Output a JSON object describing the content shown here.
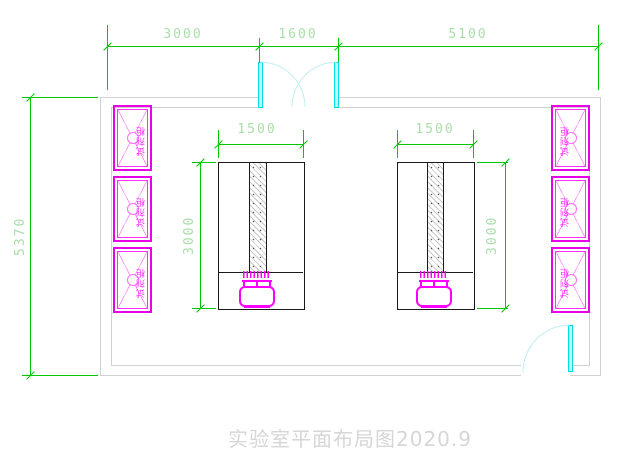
{
  "drawing": {
    "title": "实验室平面布局图2020.9",
    "type_note": "laboratory floor plan"
  },
  "dimensions": {
    "top_left_span": "3000",
    "door_span": "1600",
    "top_right_span": "5100",
    "room_depth": "5370",
    "bench_width": "1500",
    "bench_depth": "3000"
  },
  "cabinet": {
    "label": "试剂柜"
  },
  "colors": {
    "dimension_line": "#00c800",
    "dimension_text": "#a9dea9",
    "furniture_magenta": "#ff00ff",
    "door_cyan": "#00dede",
    "wall_gray": "#d0d0d0",
    "bench_outline": "#1a1a1a",
    "title_gray": "#d6d6d6"
  }
}
